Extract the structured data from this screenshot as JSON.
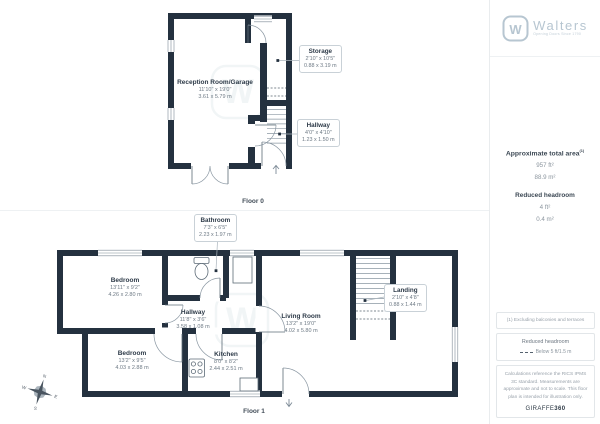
{
  "brand": {
    "name": "Walters",
    "tagline": "Opening Doors Since 1790",
    "mark": "W"
  },
  "sidebar": {
    "area_title": "Approximate total area",
    "area_sup": "(1)",
    "area_ft": "957 ft²",
    "area_m": "88.9 m²",
    "headroom_title": "Reduced headroom",
    "headroom_ft": "4 ft²",
    "headroom_m": "0.4 m²",
    "footnote": "(1) Excluding balconies and terraces",
    "legend_title": "Reduced headroom",
    "legend_text": "Below 5 ft/1.5 m",
    "disclaimer": "Calculations reference the RICS IPMS 3C standard. Measurements are approximate and not to scale. This floor plan is intended for illustration only.",
    "credit_brand": "GIRAFFE",
    "credit_num": "360"
  },
  "floor0": {
    "label": "Floor 0",
    "rooms": [
      {
        "name": "Reception Room/Garage",
        "imperial": "11'10\" x 19'0\"",
        "metric": "3.61 x 5.79 m"
      }
    ],
    "callouts": [
      {
        "name": "Storage",
        "imperial": "2'10\" x 10'5\"",
        "metric": "0.88 x 3.19 m"
      },
      {
        "name": "Hallway",
        "imperial": "4'0\" x 4'10\"",
        "metric": "1.23 x 1.50 m"
      }
    ]
  },
  "floor1": {
    "label": "Floor 1",
    "rooms": [
      {
        "name": "Bedroom",
        "imperial": "13'11\" x 9'2\"",
        "metric": "4.26 x 2.80 m"
      },
      {
        "name": "Hallway",
        "imperial": "11'8\" x 3'6\"",
        "metric": "3.58 x 1.08 m"
      },
      {
        "name": "Bedroom",
        "imperial": "13'2\" x 9'5\"",
        "metric": "4.03 x 2.88 m"
      },
      {
        "name": "Kitchen",
        "imperial": "8'0\" x 8'2\"",
        "metric": "2.44 x 2.51 m"
      },
      {
        "name": "Living Room",
        "imperial": "13'2\" x 19'0\"",
        "metric": "4.02 x 5.80 m"
      }
    ],
    "callouts": [
      {
        "name": "Bathroom",
        "imperial": "7'3\" x 6'5\"",
        "metric": "2.23 x 1.97 m"
      },
      {
        "name": "Landing",
        "imperial": "2'10\" x 4'8\"",
        "metric": "0.88 x 1.44 m"
      }
    ]
  },
  "compass": {
    "n": "N",
    "e": "E",
    "s": "S",
    "w": "W"
  },
  "colors": {
    "wall": "#24313f",
    "accent": "#b7c6d1"
  }
}
